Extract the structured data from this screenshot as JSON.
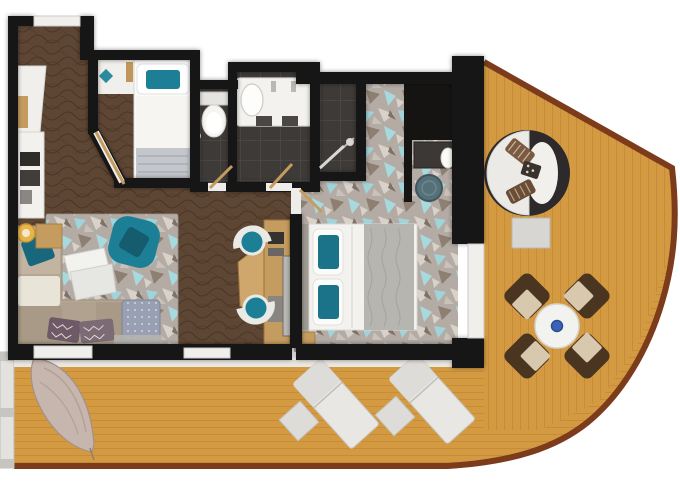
{
  "meta": {
    "type": "floor-plan",
    "description": "suite floor plan with wrap-around wooden balcony deck"
  },
  "colors": {
    "bg": "#ffffff",
    "wall": "#161412",
    "wood_floor": "#5e4634",
    "wood_floor_line": "#4a3526",
    "deck": "#d49a42",
    "deck_line": "#ba7f2e",
    "deck_trim": "#7c3c1b",
    "carpet_base": "#b4aba5",
    "carpet_teal": "#9ed4da",
    "carpet_teal2": "#a7dade",
    "carpet_light": "#d9d2cb",
    "carpet_brown": "#8d7f71",
    "carpet_dark": "#7e7265",
    "tile": "#3d3a37",
    "tile_line": "#57534f",
    "fixture_white": "#f3f2ef",
    "sofa": "#b6a794",
    "sofa_cushion": "#a89a86",
    "teal": "#1d7f95",
    "teal_dark": "#145c6e",
    "wood_furniture": "#c59c5f",
    "rug_white_table": "#f2f2ef",
    "dining_chair": "#4a3520",
    "dining_cushion": "#d8c9ae",
    "lounger": "#e8e7e3",
    "daybed_dark": "#2e2a2c",
    "daybed_white": "#eceae6",
    "daybed_pillow": "#7a5a40",
    "hammock": "#c7b6ad",
    "lamp": "#e7b54b",
    "pouf": "#567079",
    "ottoman": "#99a0b4",
    "accent_blue": "#3a62b5",
    "railing": "#e3e2de"
  },
  "rooms": [
    {
      "name": "entry-hall"
    },
    {
      "name": "single-bed-nook"
    },
    {
      "name": "wc"
    },
    {
      "name": "bathroom"
    },
    {
      "name": "shower-room"
    },
    {
      "name": "master-bedroom"
    },
    {
      "name": "living-room"
    },
    {
      "name": "balcony-deck"
    }
  ],
  "furniture": {
    "entry": [
      "wardrobe-closet",
      "minibar-shelves"
    ],
    "nook": [
      "single-bed",
      "teal-pillow",
      "shelf-decor"
    ],
    "wc": [
      "toilet"
    ],
    "bathroom": [
      "bathtub-vanity",
      "basin",
      "faucets"
    ],
    "shower": [
      "shower-rod",
      "shower-head"
    ],
    "bedroom": [
      "double-bed",
      "headboard",
      "teal-pillows",
      "bed-runner",
      "vanity-desk",
      "round-mirror",
      "vanity-pouf",
      "foot-bench"
    ],
    "living": [
      "area-rug",
      "l-shaped-sofa",
      "teal-armchair",
      "coffee-table",
      "ottoman",
      "floor-lamp",
      "side-table",
      "desk",
      "tv-console",
      "tv",
      "desk-chair",
      "desk-chair"
    ],
    "balcony": [
      "round-daybed",
      "daybed-side-table",
      "dining-table",
      "dining-chair",
      "dining-chair",
      "dining-chair",
      "dining-chair",
      "sun-lounger",
      "sun-lounger",
      "lounger-side-table",
      "lounger-side-table",
      "hanging-chair",
      "side-railing"
    ]
  }
}
